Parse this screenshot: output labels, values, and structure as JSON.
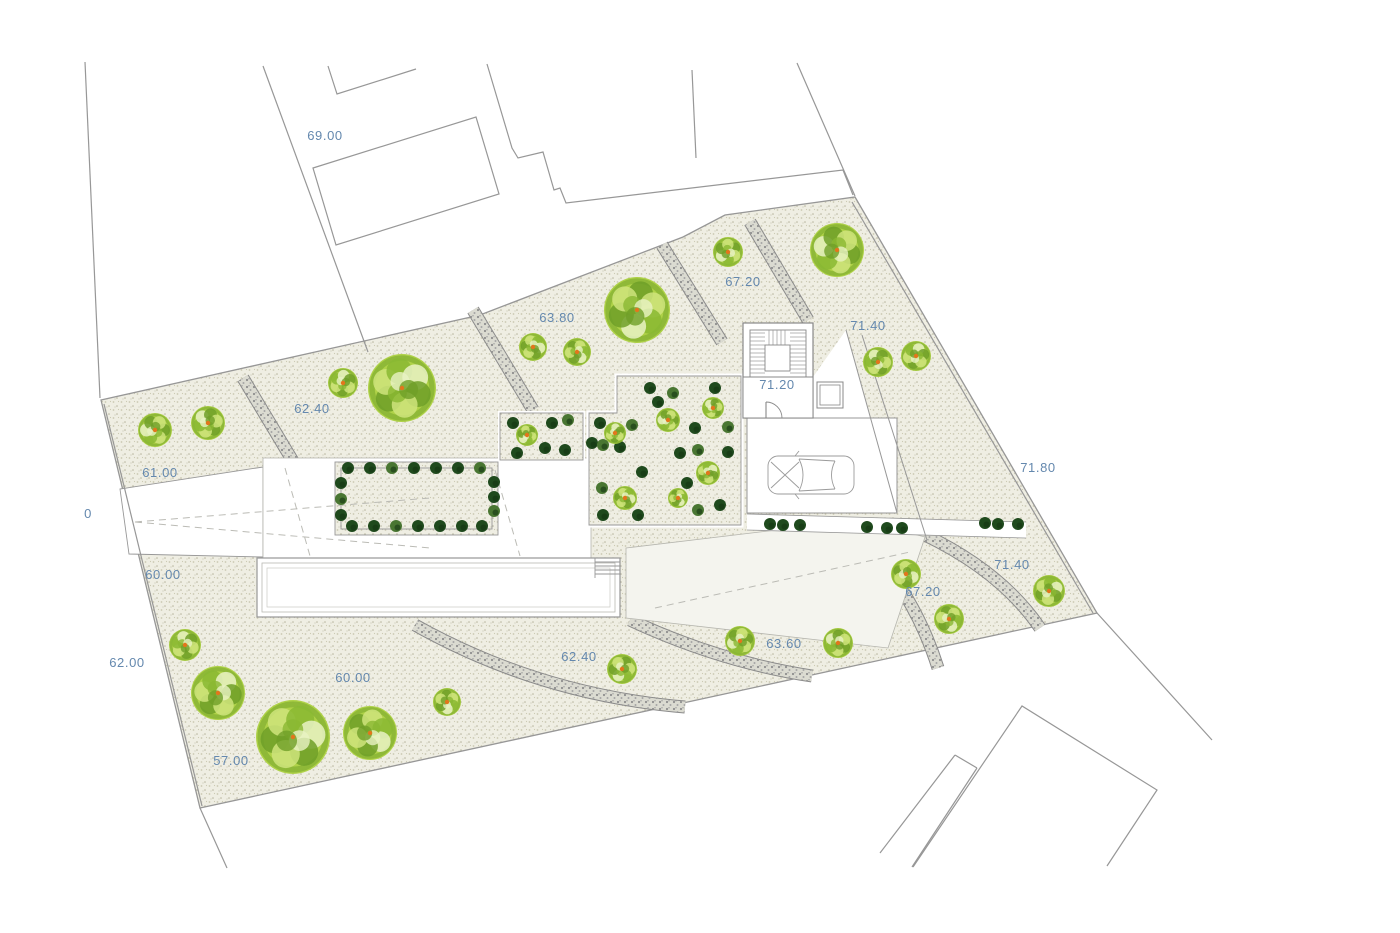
{
  "title": "site-plan",
  "colors": {
    "beige_bg": "#efeee3",
    "beige_dot1": "#cbc9b2",
    "beige_dot2": "#b7b59e",
    "path_bg": "#dbdbd1",
    "path_dot": "#8e8e8e",
    "path_edge": "#8a8a8a",
    "line": "#979797",
    "line_light": "#b8b8b2",
    "ramp": "#f4f4ee",
    "label": "#6488ae",
    "tree_base": "#abd03f",
    "tree_dark": "#6f9f28",
    "tree_mid": "#8ab832",
    "tree_light": "#cfe47d",
    "tree_pale": "#e9f2c4",
    "orange": "#e2761c",
    "bush_dark": "#1f4a1d",
    "bush_dark2": "#143613",
    "bush_mid": "#497632"
  },
  "parcel": {
    "outline": [
      [
        101,
        400
      ],
      [
        480,
        315
      ],
      [
        683,
        237
      ],
      [
        725,
        215
      ],
      [
        855,
        197
      ],
      [
        1097,
        613
      ],
      [
        200,
        808
      ]
    ]
  },
  "boundary_lines": [
    {
      "d": "M85,62 L100,398"
    },
    {
      "d": "M263,66 L368,352"
    },
    {
      "d": "M328,66 L337,94 L416,69"
    },
    {
      "d": "M313,168 L476,117 L499,194 L336,245 Z"
    },
    {
      "d": "M487,64 L512,148 L518,158 L543,152 L554,190 L560,188 L566,203 L843,170 L853,195"
    },
    {
      "d": "M692,70 L696,158"
    },
    {
      "d": "M797,63 L855,196"
    },
    {
      "d": "M1097,613 L1212,740"
    },
    {
      "d": "M913,867 L1022,706 L1157,790 L1107,866"
    },
    {
      "d": "M955,755 L880,853"
    },
    {
      "d": "M977,768 L912,867"
    },
    {
      "d": "M955,755 L977,768"
    },
    {
      "d": "M200,808 L227,868"
    },
    {
      "d": "M104,404 L202,806"
    },
    {
      "d": "M852,202 L1093,613"
    }
  ],
  "gravel_paths": [
    {
      "d": "M243,378 L297,468"
    },
    {
      "d": "M473,310 L533,410"
    },
    {
      "d": "M662,245 L722,342"
    },
    {
      "d": "M750,222 L808,320"
    },
    {
      "d": "M925,535 Q1002,572 1040,628"
    },
    {
      "d": "M862,540 Q914,592 938,668"
    },
    {
      "d": "M630,620 Q720,662 812,676"
    },
    {
      "d": "M415,625 Q540,695 685,707"
    }
  ],
  "white_areas": [
    {
      "kind": "poly",
      "pts": [
        [
          120,
          489
        ],
        [
          263,
          467
        ],
        [
          263,
          557
        ],
        [
          129,
          554
        ]
      ],
      "fill": "#ffffff",
      "stroke": "#979797",
      "sw": 0.9
    },
    {
      "kind": "rect",
      "x": 263,
      "y": 458,
      "w": 328,
      "h": 100,
      "fill": "#ffffff",
      "stroke": "#b5b5ae",
      "sw": 0.8
    },
    {
      "kind": "poly",
      "pts": [
        [
          813,
          377
        ],
        [
          846,
          330
        ],
        [
          897,
          513
        ],
        [
          813,
          513
        ]
      ],
      "fill": "#ffffff",
      "stroke": "none",
      "sw": 0
    },
    {
      "kind": "rect",
      "x": 747,
      "y": 418,
      "w": 150,
      "h": 95,
      "fill": "#ffffff",
      "stroke": "#979797",
      "sw": 1
    },
    {
      "kind": "poly",
      "pts": [
        [
          626,
          548
        ],
        [
          860,
          520
        ],
        [
          925,
          537
        ],
        [
          888,
          648
        ],
        [
          626,
          618
        ]
      ],
      "fill": "#f4f4ee",
      "stroke": "#b5b5ae",
      "sw": 0.8
    },
    {
      "kind": "rect",
      "x": 257,
      "y": 558,
      "w": 363,
      "h": 59,
      "fill": "#ffffff",
      "stroke": "#979797",
      "sw": 1.2
    },
    {
      "kind": "rect",
      "x": 262,
      "y": 563,
      "w": 353,
      "h": 49,
      "fill": "none",
      "stroke": "#b9b9b3",
      "sw": 0.8
    },
    {
      "kind": "rect",
      "x": 267,
      "y": 568,
      "w": 343,
      "h": 39,
      "fill": "none",
      "stroke": "#c9c9c3",
      "sw": 0.7
    },
    {
      "kind": "poly",
      "pts": [
        [
          747,
          514
        ],
        [
          1026,
          522
        ],
        [
          1026,
          538
        ],
        [
          747,
          530
        ]
      ],
      "fill": "#ffffff",
      "stroke": "none",
      "sw": 0
    }
  ],
  "beige_insets": [
    {
      "kind": "poly",
      "pts": [
        [
          589,
          525
        ],
        [
          589,
          413
        ],
        [
          617,
          413
        ],
        [
          617,
          376
        ],
        [
          741,
          376
        ],
        [
          741,
          525
        ]
      ],
      "whiteframe": 5
    },
    {
      "kind": "rect",
      "x": 500,
      "y": 413,
      "w": 83,
      "h": 47,
      "whiteframe": 4
    },
    {
      "kind": "rect",
      "x": 335,
      "y": 462,
      "w": 163,
      "h": 73,
      "whiteframe": 0
    },
    {
      "kind": "rect",
      "x": 341,
      "y": 468,
      "w": 151,
      "h": 61,
      "whiteframe": 0,
      "nofill": true
    }
  ],
  "detail_lines": [
    {
      "d": "M846,330 L897,513",
      "sw": 1
    },
    {
      "d": "M862,335 L927,540",
      "sw": 1
    },
    {
      "d": "M747,514 L1026,522",
      "sw": 0.8
    },
    {
      "d": "M747,530 L1026,538",
      "sw": 0.8
    },
    {
      "d": "M595,558 L595,578",
      "sw": 0.9
    },
    {
      "d": "M595,562 L620,562",
      "sw": 0.9
    },
    {
      "d": "M595,566 L620,566",
      "sw": 0.9
    },
    {
      "d": "M595,570 L620,570",
      "sw": 0.9
    },
    {
      "d": "M595,574 L620,574",
      "sw": 0.9
    }
  ],
  "dashed_lines": [
    {
      "d": "M135,522 L430,498"
    },
    {
      "d": "M135,522 L430,548"
    },
    {
      "d": "M285,468 L310,556"
    },
    {
      "d": "M495,470 L520,556"
    },
    {
      "d": "M655,608 L910,552"
    }
  ],
  "stairwell": {
    "outer": [
      743,
      323,
      70,
      95
    ],
    "flight": [
      750,
      330,
      56,
      47
    ],
    "landing": [
      765,
      345,
      25,
      26
    ],
    "room": [
      743,
      377,
      70,
      41
    ],
    "storage": [
      817,
      382,
      26,
      26
    ],
    "door_arc": "M782,418 A16,16 0 0 0 766,402",
    "door_leaf": "M766,402 L766,418"
  },
  "car": {
    "x": 811,
    "y": 475
  },
  "trees": [
    {
      "x": 155,
      "y": 430,
      "r": 17
    },
    {
      "x": 208,
      "y": 423,
      "r": 17
    },
    {
      "x": 343,
      "y": 383,
      "r": 15
    },
    {
      "x": 402,
      "y": 388,
      "r": 34
    },
    {
      "x": 533,
      "y": 347,
      "r": 14
    },
    {
      "x": 577,
      "y": 352,
      "r": 14
    },
    {
      "x": 637,
      "y": 310,
      "r": 33
    },
    {
      "x": 728,
      "y": 252,
      "r": 15
    },
    {
      "x": 837,
      "y": 250,
      "r": 27
    },
    {
      "x": 878,
      "y": 362,
      "r": 15
    },
    {
      "x": 916,
      "y": 356,
      "r": 15
    },
    {
      "x": 1049,
      "y": 591,
      "r": 16
    },
    {
      "x": 906,
      "y": 574,
      "r": 15
    },
    {
      "x": 949,
      "y": 619,
      "r": 15
    },
    {
      "x": 622,
      "y": 669,
      "r": 15
    },
    {
      "x": 740,
      "y": 641,
      "r": 15
    },
    {
      "x": 838,
      "y": 643,
      "r": 15
    },
    {
      "x": 185,
      "y": 645,
      "r": 16
    },
    {
      "x": 218,
      "y": 693,
      "r": 27
    },
    {
      "x": 293,
      "y": 737,
      "r": 37
    },
    {
      "x": 370,
      "y": 733,
      "r": 27
    },
    {
      "x": 447,
      "y": 702,
      "r": 14
    },
    {
      "x": 527,
      "y": 435,
      "r": 11
    },
    {
      "x": 668,
      "y": 420,
      "r": 12
    },
    {
      "x": 713,
      "y": 408,
      "r": 11
    },
    {
      "x": 615,
      "y": 433,
      "r": 11
    },
    {
      "x": 708,
      "y": 473,
      "r": 12
    },
    {
      "x": 625,
      "y": 498,
      "r": 12
    },
    {
      "x": 678,
      "y": 498,
      "r": 10
    }
  ],
  "bushes": [
    {
      "x": 348,
      "y": 468,
      "c": "d"
    },
    {
      "x": 370,
      "y": 468,
      "c": "d"
    },
    {
      "x": 392,
      "y": 468,
      "c": "m"
    },
    {
      "x": 414,
      "y": 468,
      "c": "d"
    },
    {
      "x": 436,
      "y": 468,
      "c": "d"
    },
    {
      "x": 458,
      "y": 468,
      "c": "d"
    },
    {
      "x": 480,
      "y": 468,
      "c": "m"
    },
    {
      "x": 352,
      "y": 526,
      "c": "d"
    },
    {
      "x": 374,
      "y": 526,
      "c": "d"
    },
    {
      "x": 396,
      "y": 526,
      "c": "m"
    },
    {
      "x": 418,
      "y": 526,
      "c": "d"
    },
    {
      "x": 440,
      "y": 526,
      "c": "d"
    },
    {
      "x": 462,
      "y": 526,
      "c": "d"
    },
    {
      "x": 482,
      "y": 526,
      "c": "d"
    },
    {
      "x": 341,
      "y": 483,
      "c": "d"
    },
    {
      "x": 341,
      "y": 499,
      "c": "m"
    },
    {
      "x": 341,
      "y": 515,
      "c": "d"
    },
    {
      "x": 494,
      "y": 482,
      "c": "d"
    },
    {
      "x": 494,
      "y": 497,
      "c": "d"
    },
    {
      "x": 494,
      "y": 511,
      "c": "m"
    },
    {
      "x": 513,
      "y": 423,
      "c": "d"
    },
    {
      "x": 552,
      "y": 423,
      "c": "d"
    },
    {
      "x": 568,
      "y": 420,
      "c": "m"
    },
    {
      "x": 545,
      "y": 448,
      "c": "d"
    },
    {
      "x": 565,
      "y": 450,
      "c": "d"
    },
    {
      "x": 517,
      "y": 453,
      "c": "d"
    },
    {
      "x": 650,
      "y": 388,
      "c": "d"
    },
    {
      "x": 673,
      "y": 393,
      "c": "m"
    },
    {
      "x": 658,
      "y": 402,
      "c": "d"
    },
    {
      "x": 715,
      "y": 388,
      "c": "d"
    },
    {
      "x": 600,
      "y": 423,
      "c": "d"
    },
    {
      "x": 632,
      "y": 425,
      "c": "m"
    },
    {
      "x": 695,
      "y": 428,
      "c": "d"
    },
    {
      "x": 728,
      "y": 427,
      "c": "m"
    },
    {
      "x": 592,
      "y": 443,
      "c": "d"
    },
    {
      "x": 603,
      "y": 445,
      "c": "m"
    },
    {
      "x": 620,
      "y": 447,
      "c": "d"
    },
    {
      "x": 680,
      "y": 453,
      "c": "d"
    },
    {
      "x": 698,
      "y": 450,
      "c": "m"
    },
    {
      "x": 728,
      "y": 452,
      "c": "d"
    },
    {
      "x": 642,
      "y": 472,
      "c": "d"
    },
    {
      "x": 687,
      "y": 483,
      "c": "d"
    },
    {
      "x": 602,
      "y": 488,
      "c": "m"
    },
    {
      "x": 603,
      "y": 515,
      "c": "d"
    },
    {
      "x": 638,
      "y": 515,
      "c": "d"
    },
    {
      "x": 698,
      "y": 510,
      "c": "m"
    },
    {
      "x": 720,
      "y": 505,
      "c": "d"
    },
    {
      "x": 770,
      "y": 524,
      "c": "d"
    },
    {
      "x": 783,
      "y": 525,
      "c": "d"
    },
    {
      "x": 800,
      "y": 525,
      "c": "d"
    },
    {
      "x": 867,
      "y": 527,
      "c": "d"
    },
    {
      "x": 887,
      "y": 528,
      "c": "d"
    },
    {
      "x": 902,
      "y": 528,
      "c": "d"
    },
    {
      "x": 985,
      "y": 523,
      "c": "d"
    },
    {
      "x": 998,
      "y": 524,
      "c": "d"
    },
    {
      "x": 1018,
      "y": 524,
      "c": "d"
    }
  ],
  "elevation_labels": [
    {
      "text": "69.00",
      "x": 325,
      "y": 140
    },
    {
      "text": "63.80",
      "x": 557,
      "y": 322
    },
    {
      "text": "62.40",
      "x": 312,
      "y": 413
    },
    {
      "text": "61.00",
      "x": 160,
      "y": 477
    },
    {
      "text": "0",
      "x": 88,
      "y": 518
    },
    {
      "text": "60.00",
      "x": 163,
      "y": 579
    },
    {
      "text": "62.00",
      "x": 127,
      "y": 667
    },
    {
      "text": "57.00",
      "x": 231,
      "y": 765
    },
    {
      "text": "60.00",
      "x": 353,
      "y": 682
    },
    {
      "text": "62.40",
      "x": 579,
      "y": 661
    },
    {
      "text": "63.60",
      "x": 784,
      "y": 648
    },
    {
      "text": "67.20",
      "x": 743,
      "y": 286
    },
    {
      "text": "71.40",
      "x": 868,
      "y": 330
    },
    {
      "text": "71.20",
      "x": 777,
      "y": 389
    },
    {
      "text": "71.80",
      "x": 1038,
      "y": 472
    },
    {
      "text": "67.20",
      "x": 923,
      "y": 596
    },
    {
      "text": "71.40",
      "x": 1012,
      "y": 569
    }
  ]
}
